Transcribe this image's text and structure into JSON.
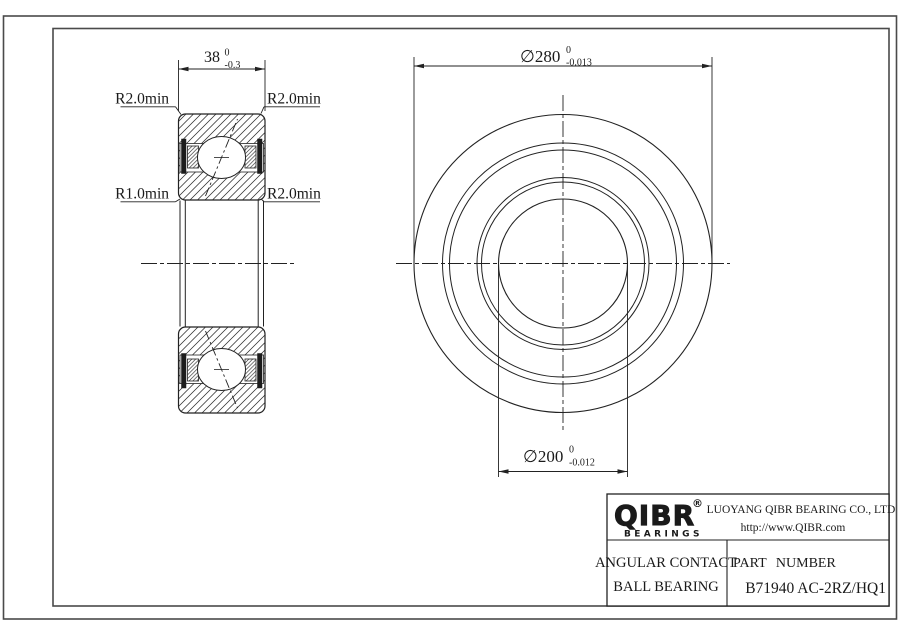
{
  "section_view": {
    "width_dim": {
      "value": "38",
      "tol_upper": "0",
      "tol_lower": "-0.3"
    },
    "labels": {
      "top_left": "R2.0min",
      "top_right": "R2.0min",
      "bottom_left": "R1.0min",
      "bottom_right": "R2.0min"
    }
  },
  "front_view": {
    "outer_dia": {
      "symbol": "∅",
      "value": "280",
      "tol_upper": "0",
      "tol_lower": "-0.013"
    },
    "bore_dia": {
      "symbol": "∅",
      "value": "200",
      "tol_upper": "0",
      "tol_lower": "-0.012"
    }
  },
  "title_block": {
    "logo_text": "QIBR",
    "registered_mark": "®",
    "logo_subtext": "BEARINGS",
    "company_name": "LUOYANG QIBR BEARING CO., LTD",
    "website": "http://www.QIBR.com",
    "product_line1": "ANGULAR CONTACT",
    "product_line2": "BALL BEARING",
    "part_number_label": "PART NUMBER",
    "part_number": "B71940 AC-2RZ/HQ1"
  },
  "colors": {
    "line": "#222222",
    "frame": "#4a4a4a",
    "background": "#ffffff"
  }
}
